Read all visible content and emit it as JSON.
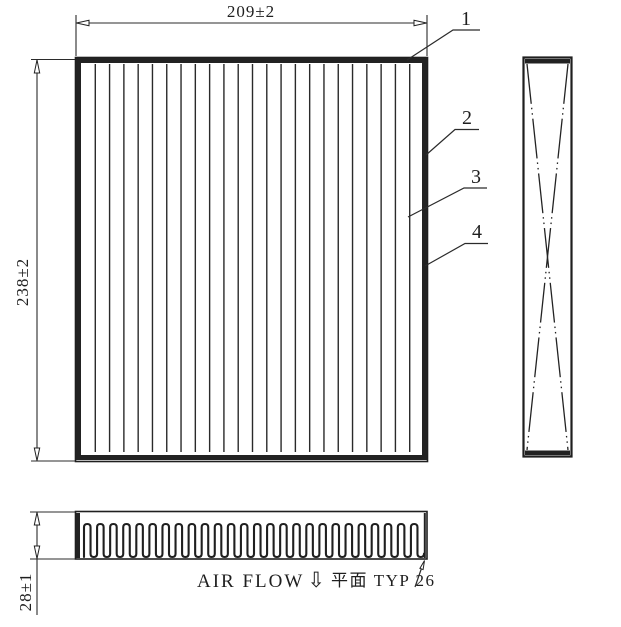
{
  "drawing": {
    "views": {
      "front": {
        "pleat_line_count": 23
      },
      "bottom": {
        "pleat_count": 26
      }
    },
    "dimensions": {
      "width": {
        "label": "209±2"
      },
      "height": {
        "label": "238±2"
      },
      "depth": {
        "label": "28±1"
      }
    },
    "callouts": [
      {
        "label": "1"
      },
      {
        "label": "2"
      },
      {
        "label": "3"
      },
      {
        "label": "4"
      }
    ],
    "annotations": {
      "air_flow": {
        "label": "AIR FLOW",
        "arrow_icon": "⇩",
        "direction": "down"
      },
      "pleat_note": {
        "label": "平面 TYP 26"
      }
    },
    "colors": {
      "line": "#1f1f1f",
      "background": "#ffffff"
    }
  }
}
